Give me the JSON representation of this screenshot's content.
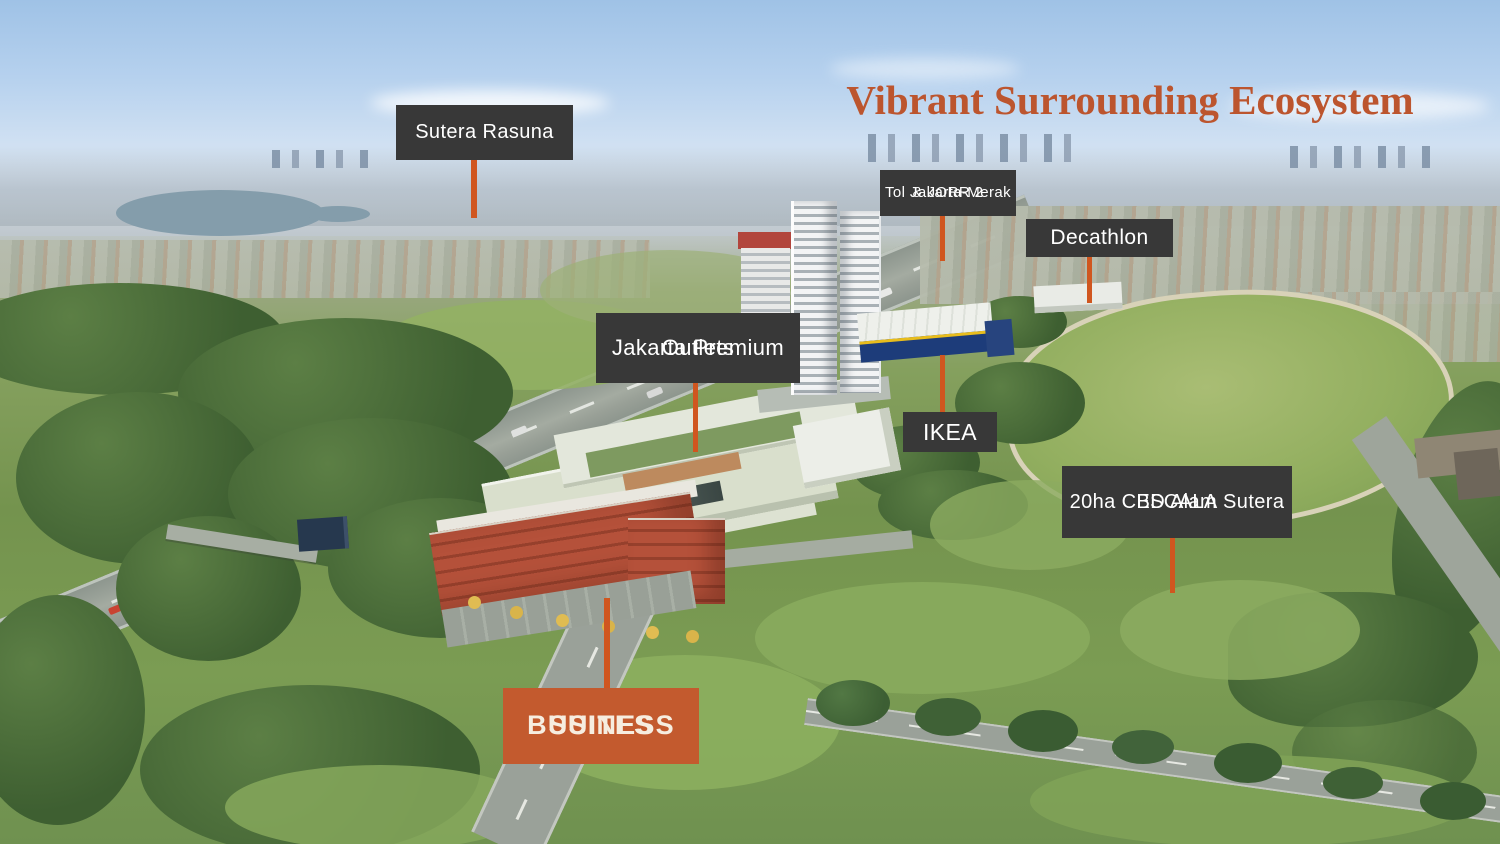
{
  "slide": {
    "width": 1500,
    "height": 844
  },
  "title": {
    "text": "Vibrant Surrounding Ecosystem"
  },
  "colors": {
    "label_box_bg": "#383838",
    "label_text": "#FFFFFF",
    "pointer_line": "#D0561F",
    "accent_box_bg": "#C35A2E",
    "accent_box_text": "#F6EDE0",
    "title_color": "#BC552E"
  },
  "callouts": [
    {
      "id": "sutera-rasuna",
      "variant": "dark",
      "pointer_direction": "down",
      "lines": [
        "Sutera Rasuna"
      ]
    },
    {
      "id": "tol-jakarta-merak-jorr2",
      "variant": "dark",
      "pointer_direction": "down",
      "lines": [
        "Tol Jakarta-Merak",
        "& JORR 2"
      ]
    },
    {
      "id": "decathlon",
      "variant": "dark",
      "pointer_direction": "down",
      "lines": [
        "Decathlon"
      ]
    },
    {
      "id": "jakarta-premium-outlets",
      "variant": "dark",
      "pointer_direction": "down",
      "lines": [
        "Jakarta Premium",
        "Outlets"
      ]
    },
    {
      "id": "ikea",
      "variant": "dark",
      "pointer_direction": "up",
      "lines": [
        "IKEA"
      ]
    },
    {
      "id": "escala-cbd-alam-sutera",
      "variant": "dark",
      "pointer_direction": "down",
      "lines": [
        "ESCALA",
        "20ha CBD Alam Sutera"
      ]
    },
    {
      "id": "business-suites",
      "variant": "accent",
      "pointer_direction": "up",
      "lines": [
        "BUSINESS",
        "SUITES"
      ]
    }
  ]
}
